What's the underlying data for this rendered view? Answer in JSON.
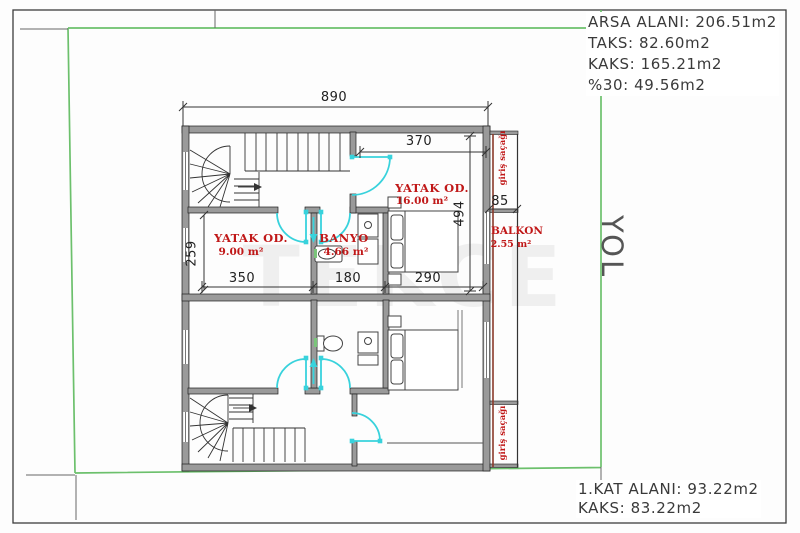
{
  "site_info": {
    "arsa": "ARSA ALANI: 206.51m2",
    "taks": "TAKS: 82.60m2",
    "kaks": "KAKS: 165.21m2",
    "pct30": "%30: 49.56m2"
  },
  "floor_info": {
    "kat_alani": "1.KAT ALANI: 93.22m2",
    "kaks": "KAKS: 83.22m2"
  },
  "road_label": "YOL",
  "watermark": "TEKCE",
  "rooms": {
    "bedroom_left": {
      "name": "YATAK OD.",
      "area": "9.00 m²"
    },
    "bathroom": {
      "name": "BANYO",
      "area": "4.66 m²"
    },
    "bedroom_right": {
      "name": "YATAK OD.",
      "area": "16.00 m²"
    },
    "balcony": {
      "name": "BALKON",
      "area": "2.55 m²"
    },
    "entry_canopy_top": {
      "name": "giriş saçağı"
    },
    "entry_canopy_bottom": {
      "name": "giriş saçağı"
    }
  },
  "dimensions": {
    "total_width": "890",
    "right_room_width": "370",
    "right_room_height": "494",
    "balcony_width": "85",
    "left_room_height": "259",
    "left_room_width": "350",
    "bath_width": "180",
    "right_width": "290"
  },
  "colors": {
    "boundary_green": "#6cc06c",
    "wall_gray": "#9a9a9a",
    "door_cyan": "#38d2dc",
    "label_red": "#c01818"
  }
}
